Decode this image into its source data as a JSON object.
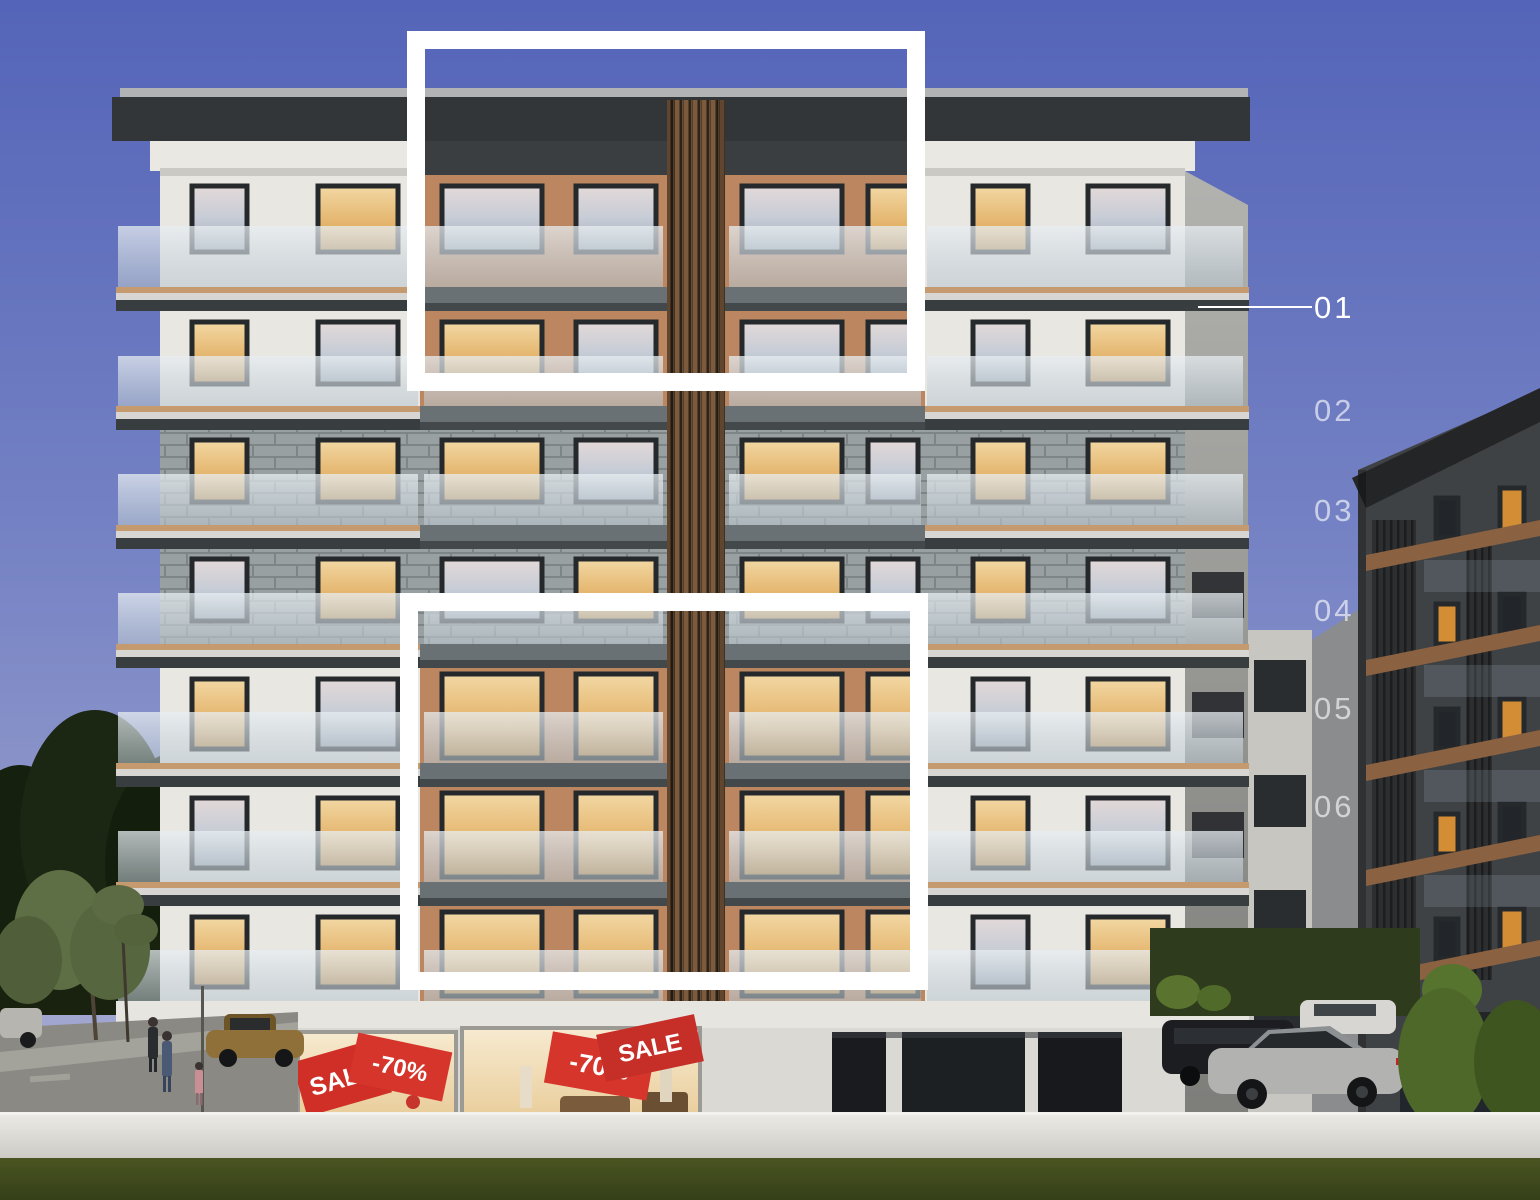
{
  "overlay": {
    "highlight_color": "#ffffff",
    "floor_labels": [
      {
        "label": "01",
        "selected": true
      },
      {
        "label": "02",
        "selected": false
      },
      {
        "label": "03",
        "selected": false
      },
      {
        "label": "04",
        "selected": false
      },
      {
        "label": "05",
        "selected": false
      },
      {
        "label": "06",
        "selected": false
      }
    ]
  },
  "shopfront": {
    "banners": [
      "SALE",
      "-70%",
      "-70%",
      "SALE"
    ],
    "banner_color": "#cf2f27",
    "banner_text_color": "#ffffff"
  },
  "palette": {
    "sky_top": "#5464b8",
    "sky_bottom": "#b3b6d6",
    "facade_white": "#e9e7e2",
    "facade_tan": "#bb8660",
    "brick_gray": "#99a0a2",
    "slab_gray": "#6a7175",
    "wood_trim": "#c49a6e",
    "glass": "#d9e2e8",
    "warm_window": "#e8bf7b",
    "grass": "#46511f",
    "sale_red": "#cf2f27",
    "highlight_white": "#ffffff"
  }
}
